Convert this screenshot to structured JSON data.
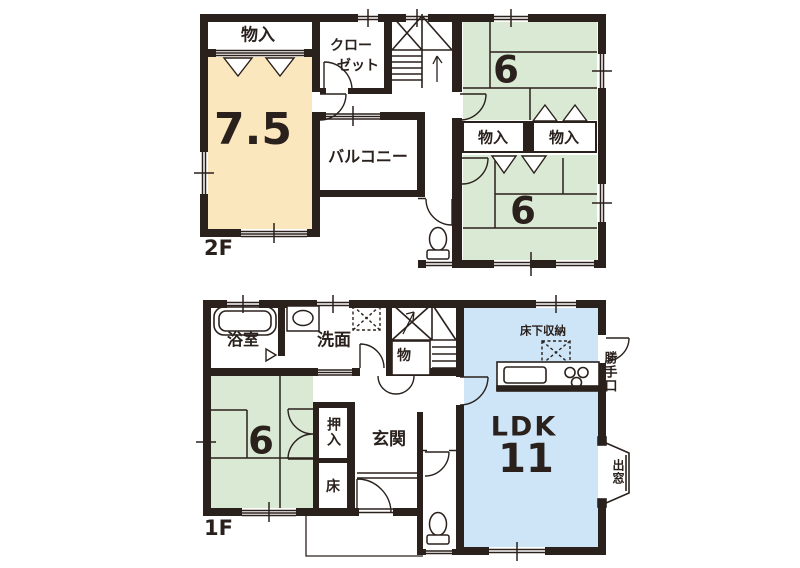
{
  "plan2f": {
    "floor_label": "2F",
    "rooms": {
      "storage_top": {
        "label": "物入"
      },
      "closet": {
        "line1": "クロー",
        "line2": "ゼット"
      },
      "western_room": {
        "size": "7.5"
      },
      "balcony": {
        "label": "バルコニー"
      },
      "tatami_upper": {
        "size": "6"
      },
      "storage_right_a": {
        "label": "物入"
      },
      "storage_right_b": {
        "label": "物入"
      },
      "tatami_lower": {
        "size": "6"
      }
    }
  },
  "plan1f": {
    "floor_label": "1F",
    "rooms": {
      "bathroom": {
        "label": "浴室"
      },
      "washroom": {
        "label": "洗面"
      },
      "closet_under_stairs": {
        "label": "物"
      },
      "tatami": {
        "size": "6"
      },
      "oshiire": {
        "label": "押入"
      },
      "tokonoma": {
        "label": "床"
      },
      "entrance": {
        "label": "玄関"
      },
      "ldk": {
        "label": "LDK",
        "size": "11"
      },
      "underfloor_storage": {
        "label": "床下収納"
      },
      "back_door": {
        "label": "勝手口"
      },
      "bay_window": {
        "label": "出窓"
      }
    }
  },
  "colors": {
    "wall": "#2a211d",
    "ink": "#2a211d",
    "western_room": "#fbe7bd",
    "tatami": "#d9e9d4",
    "ldk": "#cde5f7"
  }
}
